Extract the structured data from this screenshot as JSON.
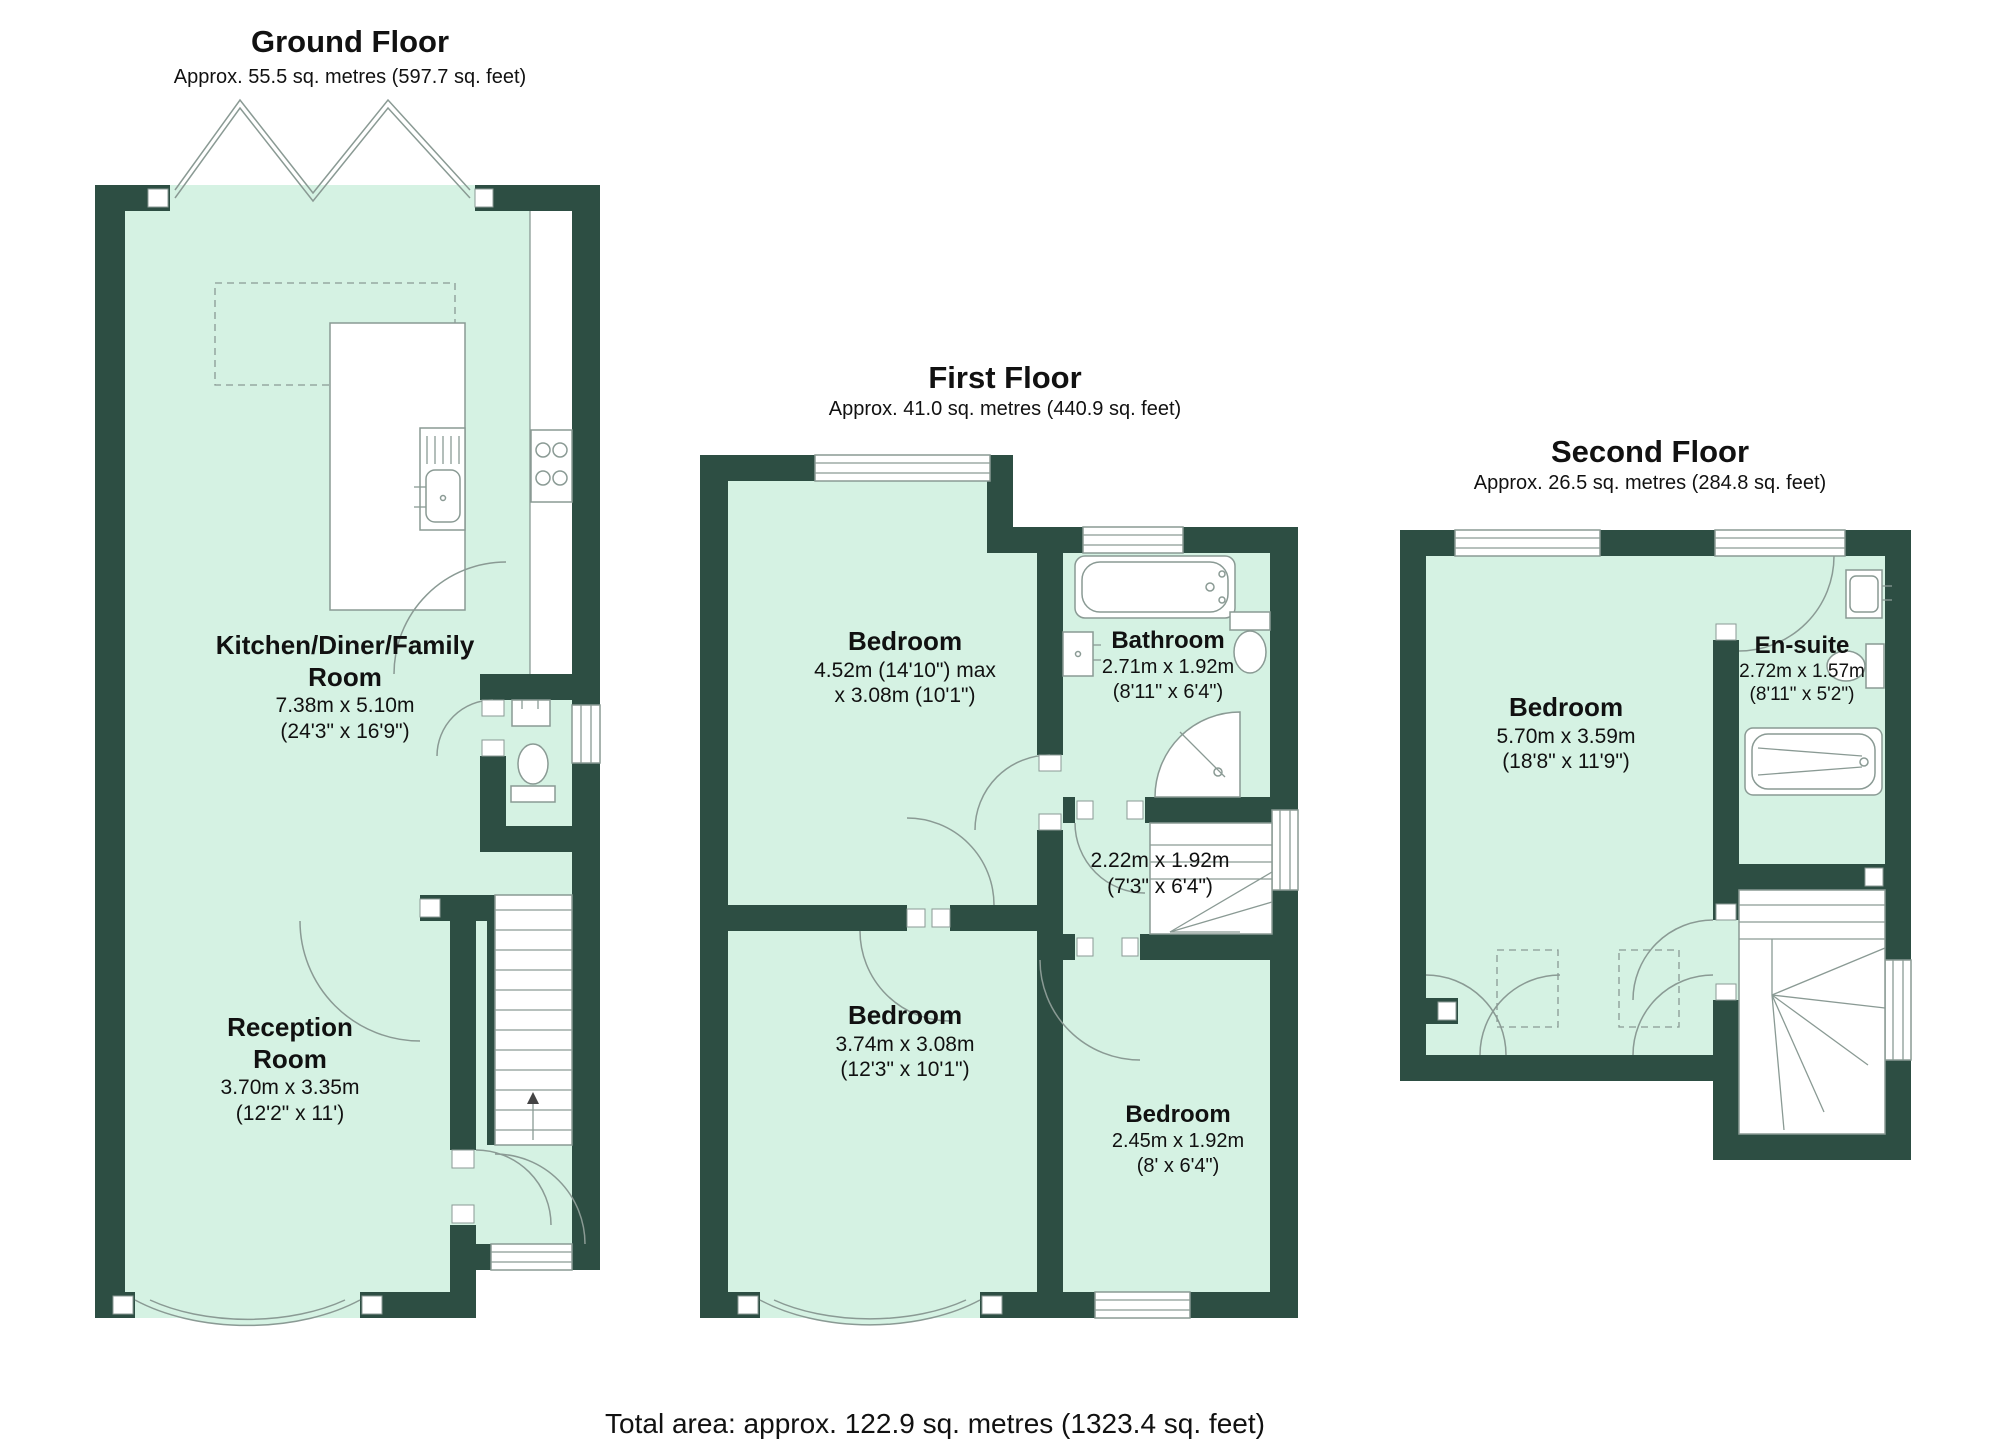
{
  "colors": {
    "wall": "#2d4e43",
    "floor": "#d5f2e3",
    "line": "#8a9a94",
    "text": "#111111"
  },
  "floors": [
    {
      "title": "Ground Floor",
      "subtitle": "Approx. 55.5 sq. metres (597.7 sq. feet)"
    },
    {
      "title": "First Floor",
      "subtitle": "Approx. 41.0 sq. metres (440.9 sq. feet)"
    },
    {
      "title": "Second Floor",
      "subtitle": "Approx. 26.5 sq. metres (284.8 sq. feet)"
    }
  ],
  "rooms": {
    "kitchen": {
      "name_line1": "Kitchen/Diner/Family",
      "name_line2": "Room",
      "dims": "7.38m x 5.10m",
      "dims_ft": "(24'3\" x 16'9\")"
    },
    "reception": {
      "name_line1": "Reception",
      "name_line2": "Room",
      "dims": "3.70m x 3.35m",
      "dims_ft": "(12'2\" x 11')"
    },
    "bedroom1": {
      "name": "Bedroom",
      "dims": "4.52m (14'10\") max",
      "dims_ft": "x 3.08m (10'1\")"
    },
    "bathroom": {
      "name": "Bathroom",
      "dims": "2.71m x 1.92m",
      "dims_ft": "(8'11\" x 6'4\")"
    },
    "landing": {
      "dims": "2.22m x 1.92m",
      "dims_ft": "(7'3\" x 6'4\")"
    },
    "bedroom2": {
      "name": "Bedroom",
      "dims": "3.74m x 3.08m",
      "dims_ft": "(12'3\" x 10'1\")"
    },
    "bedroom3": {
      "name": "Bedroom",
      "dims": "2.45m x 1.92m",
      "dims_ft": "(8' x 6'4\")"
    },
    "bedroom4": {
      "name": "Bedroom",
      "dims": "5.70m x 3.59m",
      "dims_ft": "(18'8\" x 11'9\")"
    },
    "ensuite": {
      "name": "En-suite",
      "dims": "2.72m x 1.57m",
      "dims_ft": "(8'11\" x 5'2\")"
    }
  },
  "footer": {
    "total_area": "Total area: approx. 122.9 sq. metres (1323.4 sq. feet)"
  }
}
